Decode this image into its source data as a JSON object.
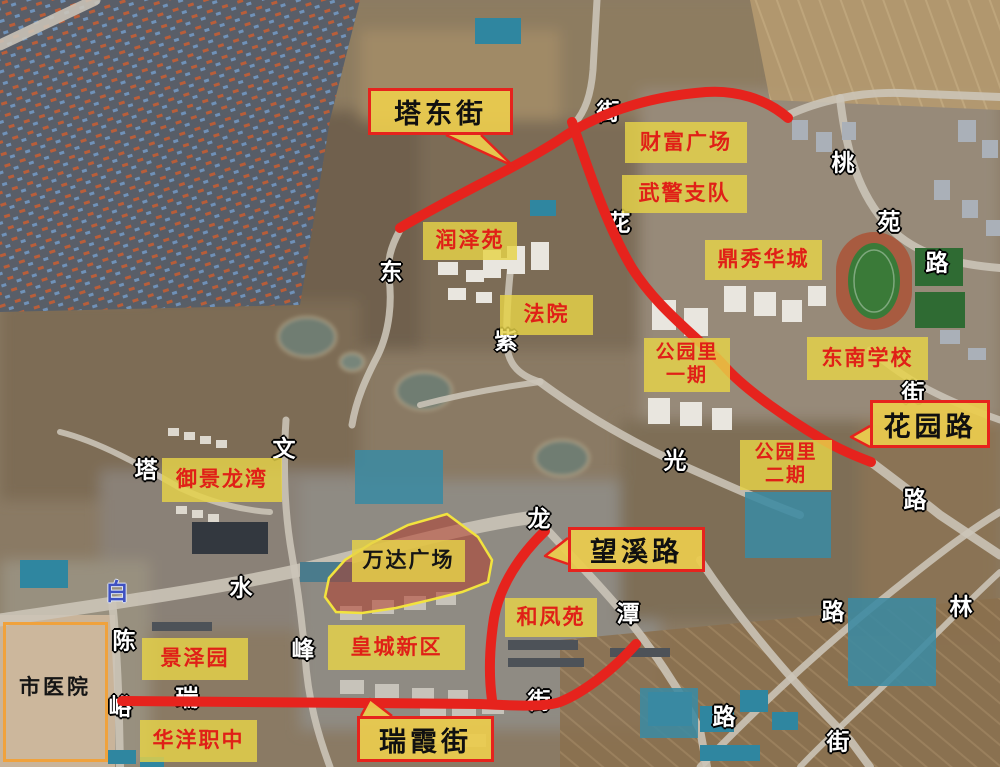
{
  "map": {
    "description_label": "annotated satellite map",
    "colors": {
      "road_highlight": "#e6231d",
      "label_background": "#e7d348",
      "label_text_red": "#e02017",
      "label_text_black": "#151515",
      "callout_border": "#e6231d",
      "hospital_border": "#f0a23c",
      "street_char_white": "#ffffff",
      "street_char_blue": "#3f51c1",
      "highlight_area_fill": "#b23e2c",
      "highlight_area_outline": "#f2e33e"
    },
    "road_callouts": [
      {
        "id": "ta-dong-jie",
        "label": "塔东街",
        "x": 368,
        "y": 88,
        "w": 145,
        "h": 47
      },
      {
        "id": "wang-xi-lu",
        "label": "望溪路",
        "x": 568,
        "y": 527,
        "w": 137,
        "h": 45
      },
      {
        "id": "hua-yuan-lu",
        "label": "花园路",
        "x": 870,
        "y": 400,
        "w": 120,
        "h": 48
      },
      {
        "id": "rui-xia-jie",
        "label": "瑞霞街",
        "x": 357,
        "y": 716,
        "w": 137,
        "h": 46
      }
    ],
    "place_labels": [
      {
        "id": "cai-fu-guang-chang",
        "label": "财富广场",
        "x": 625,
        "y": 122,
        "w": 122,
        "h": 41
      },
      {
        "id": "wu-jing-zhi-dui",
        "label": "武警支队",
        "x": 622,
        "y": 175,
        "w": 125,
        "h": 38
      },
      {
        "id": "ding-xiu-hua-cheng",
        "label": "鼎秀华城",
        "x": 705,
        "y": 240,
        "w": 117,
        "h": 40
      },
      {
        "id": "dong-nan-xue-xiao",
        "label": "东南学校",
        "x": 807,
        "y": 337,
        "w": 121,
        "h": 43
      },
      {
        "id": "gong-yuan-li-yi-qi",
        "label": "公园里 一期",
        "lines": [
          "公园里",
          "一期"
        ],
        "x": 644,
        "y": 338,
        "w": 86,
        "h": 54,
        "small": true
      },
      {
        "id": "gong-yuan-li-er-qi",
        "label": "公园里 二期",
        "lines": [
          "公园里",
          "二期"
        ],
        "x": 740,
        "y": 440,
        "w": 92,
        "h": 50,
        "small": true
      },
      {
        "id": "run-ze-yuan",
        "label": "润泽苑",
        "x": 423,
        "y": 222,
        "w": 94,
        "h": 38
      },
      {
        "id": "fa-yuan",
        "label": "法院",
        "x": 500,
        "y": 295,
        "w": 93,
        "h": 40
      },
      {
        "id": "yu-jing-long-wan",
        "label": "御景龙湾",
        "x": 162,
        "y": 458,
        "w": 120,
        "h": 44
      },
      {
        "id": "he-feng-yuan",
        "label": "和凤苑",
        "x": 505,
        "y": 598,
        "w": 92,
        "h": 39
      },
      {
        "id": "huang-cheng-xin-qu",
        "label": "皇城新区",
        "x": 328,
        "y": 625,
        "w": 137,
        "h": 45
      },
      {
        "id": "jing-ze-yuan",
        "label": "景泽园",
        "x": 142,
        "y": 638,
        "w": 106,
        "h": 42
      },
      {
        "id": "hua-yang-zhi-zhong",
        "label": "华洋职中",
        "x": 140,
        "y": 720,
        "w": 117,
        "h": 42
      },
      {
        "id": "wan-da-guang-chang",
        "label": "万达广场",
        "x": 352,
        "y": 540,
        "w": 113,
        "h": 42,
        "text_color": "black"
      }
    ],
    "hospital": {
      "label": "市医院"
    },
    "street_names": [
      {
        "char": "街",
        "x": 608,
        "y": 112,
        "under": true
      },
      {
        "char": "花",
        "x": 619,
        "y": 223,
        "under": true
      },
      {
        "char": "东",
        "x": 391,
        "y": 272
      },
      {
        "char": "紫",
        "x": 506,
        "y": 341
      },
      {
        "char": "桃",
        "x": 843,
        "y": 163
      },
      {
        "char": "苑",
        "x": 889,
        "y": 222
      },
      {
        "char": "路",
        "x": 937,
        "y": 263
      },
      {
        "char": "街",
        "x": 913,
        "y": 393
      },
      {
        "char": "路",
        "x": 915,
        "y": 500
      },
      {
        "char": "文",
        "x": 284,
        "y": 449
      },
      {
        "char": "塔",
        "x": 146,
        "y": 470
      },
      {
        "char": "光",
        "x": 675,
        "y": 461
      },
      {
        "char": "龙",
        "x": 539,
        "y": 519
      },
      {
        "char": "水",
        "x": 241,
        "y": 588
      },
      {
        "char": "白",
        "x": 117,
        "y": 592,
        "color": "blue"
      },
      {
        "char": "潭",
        "x": 628,
        "y": 614
      },
      {
        "char": "路",
        "x": 833,
        "y": 612
      },
      {
        "char": "林",
        "x": 961,
        "y": 607
      },
      {
        "char": "路",
        "x": 724,
        "y": 717
      },
      {
        "char": "街",
        "x": 838,
        "y": 742
      },
      {
        "char": "陈",
        "x": 124,
        "y": 641
      },
      {
        "char": "峪",
        "x": 120,
        "y": 707,
        "under": true
      },
      {
        "char": "瑞",
        "x": 187,
        "y": 698,
        "under": true
      },
      {
        "char": "街",
        "x": 539,
        "y": 701,
        "under": true
      },
      {
        "char": "峰",
        "x": 303,
        "y": 650
      }
    ]
  }
}
